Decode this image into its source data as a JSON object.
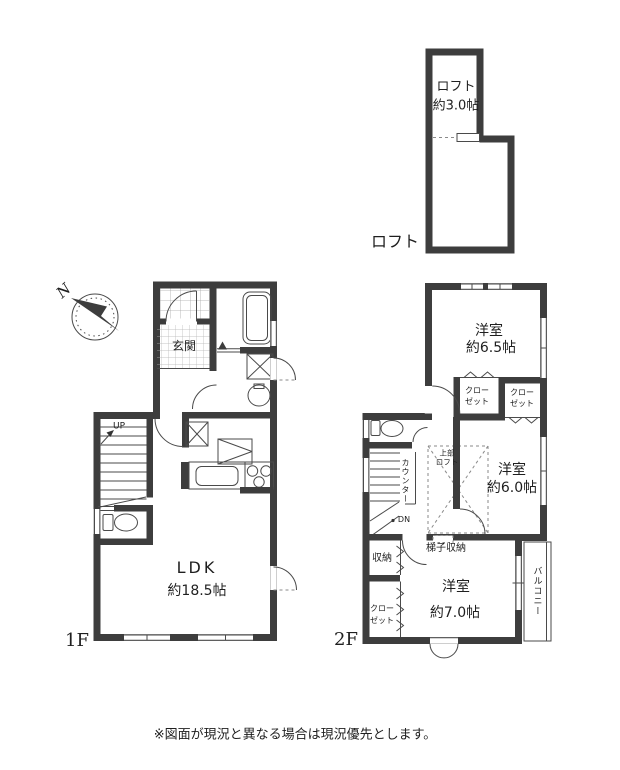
{
  "loft": {
    "room_label": "ロフト",
    "room_size": "約3.0帖",
    "floor_label": "ロフト"
  },
  "f1": {
    "floor_label": "1F",
    "entrance": "玄関",
    "up": "UP",
    "ldk_name": "LDK",
    "ldk_size": "約18.5帖"
  },
  "f2": {
    "floor_label": "2F",
    "room65_name": "洋室",
    "room65_size": "約6.5帖",
    "closet_a_line1": "クロー",
    "closet_a_line2": "ゼット",
    "closet_b_line1": "クロー",
    "closet_b_line2": "ゼット",
    "counter": "カウンター",
    "dn": "DN",
    "upper_loft_line1": "上部",
    "upper_loft_line2": "ロフト",
    "room60_name": "洋室",
    "room60_size": "約6.0帖",
    "ladder_storage": "梯子収納",
    "storage": "収納",
    "closet_c_line1": "クロー",
    "closet_c_line2": "ゼット",
    "room70_name": "洋室",
    "room70_size": "約7.0帖",
    "balcony": "バルコニー"
  },
  "compass": {
    "north": "N"
  },
  "footer": {
    "note": "※図面が現況と異なる場合は現況優先とします。"
  },
  "colors": {
    "wall": "#3d3d3d",
    "line": "#4a4a4a",
    "dash": "#8a8a8a",
    "text": "#1f1f1f",
    "bg": "#ffffff"
  }
}
